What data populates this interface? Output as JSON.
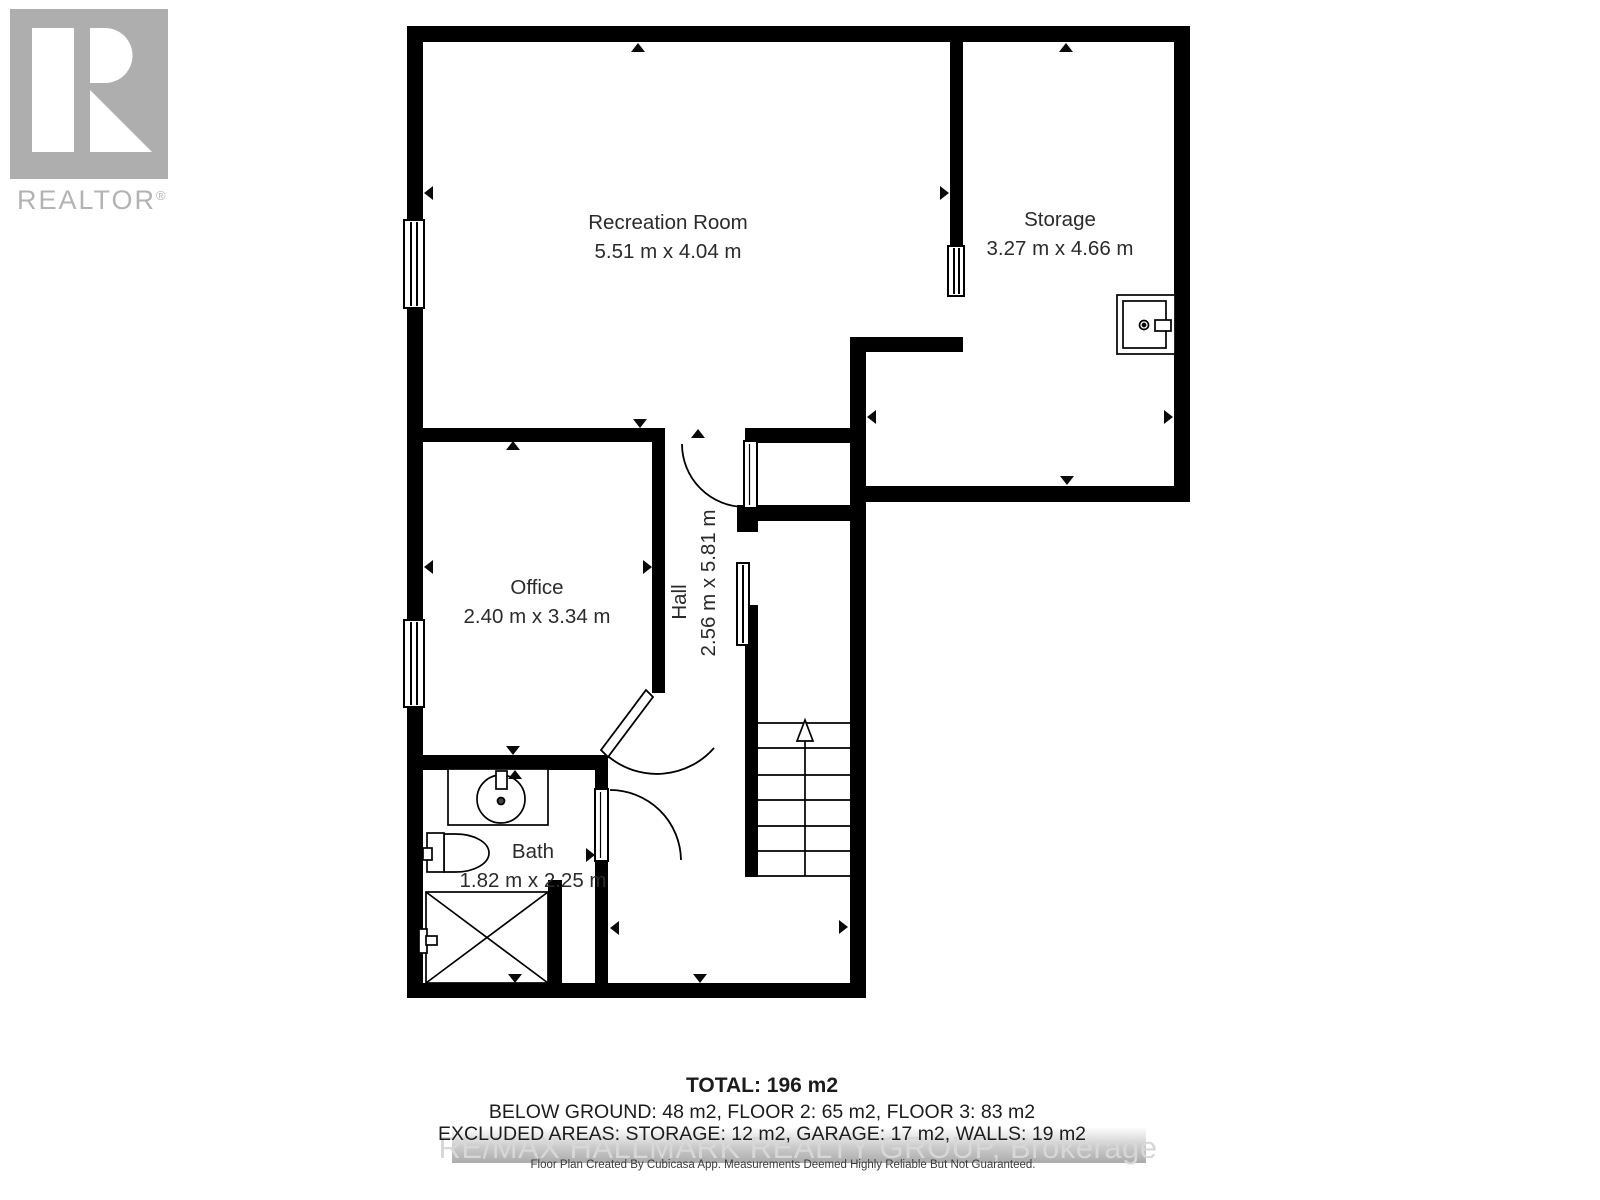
{
  "logo": {
    "brand": "REALTOR",
    "registered": "®"
  },
  "rooms": {
    "recreation": {
      "name": "Recreation Room",
      "dimensions": "5.51 m x 4.04 m"
    },
    "storage": {
      "name": "Storage",
      "dimensions": "3.27 m x 4.66 m"
    },
    "office": {
      "name": "Office",
      "dimensions": "2.40 m x 3.34 m"
    },
    "hall": {
      "name": "Hall",
      "dimensions": "2.56 m x 5.81 m"
    },
    "bath": {
      "name": "Bath",
      "dimensions": "1.82 m x 2.25 m"
    }
  },
  "summary": {
    "total": "TOTAL: 196 m2",
    "floors": "BELOW GROUND: 48 m2, FLOOR 2: 65 m2, FLOOR 3: 83 m2",
    "excluded": "EXCLUDED AREAS: STORAGE: 12 m2, GARAGE: 17 m2, WALLS: 19 m2"
  },
  "watermark": "RE/MAX HALLMARK REALTY GROUP, Brokerage",
  "disclaimer": "Floor Plan Created By Cubicasa App. Measurements Deemed Highly Reliable But Not Guaranteed.",
  "colors": {
    "wall": "#000000",
    "label": "#2b2b2b",
    "watermark": "#d7d7d7",
    "logo_gray": "#aeaeae"
  }
}
